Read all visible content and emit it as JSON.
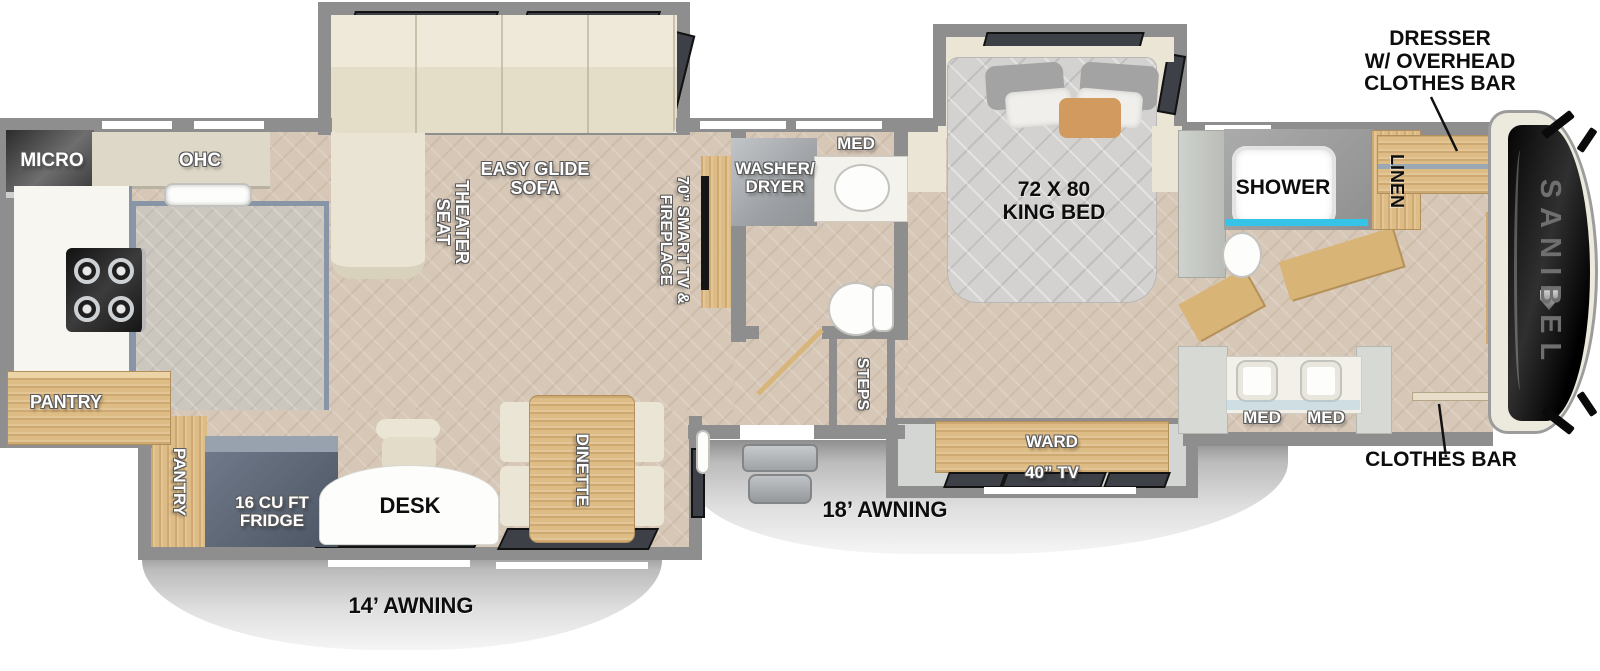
{
  "title": "Sanibel fifth wheel RV floorplan",
  "brand": "SANIBEL",
  "colors": {
    "wall": "#8e8e8e",
    "wood": "#debc85",
    "sofa_cream": "#eae5d4",
    "floor": "#d6c7b7",
    "kitchen_tile": "#ccc7be",
    "shower_glass": "#35c3e8",
    "fridge": "#5b6573",
    "awning": "#dedede",
    "annotation": "#0d0d0d"
  },
  "labels": {
    "micro": "MICRO",
    "ohc": "OHC",
    "pantry_kitchen": "PANTRY",
    "theater_seat": "THEATER SEAT",
    "easy_glide_sofa": "EASY GLIDE SOFA",
    "smart_tv_fireplace": "70” SMART TV & FIREPLACE",
    "washer_dryer": "WASHER/ DRYER",
    "med_half_bath": "MED",
    "steps": "STEPS",
    "king_bed": "72 X 80 KING BED",
    "shower": "SHOWER",
    "linen": "LINEN",
    "note_dresser_lines": [
      "DRESSER",
      "W/ OVERHEAD",
      "CLOTHES BAR"
    ],
    "note_clothes_bar": "CLOTHES BAR",
    "med_left": "MED",
    "med_right": "MED",
    "ward": "WARD",
    "tv_40": "40” TV",
    "awning_18": "18’ AWNING",
    "dinette": "DINETTE",
    "desk": "DESK",
    "fridge": "16 CU FT FRIDGE",
    "pantry_slide": "PANTRY",
    "awning_14": "14’ AWNING",
    "brand": "SANIBEL"
  }
}
